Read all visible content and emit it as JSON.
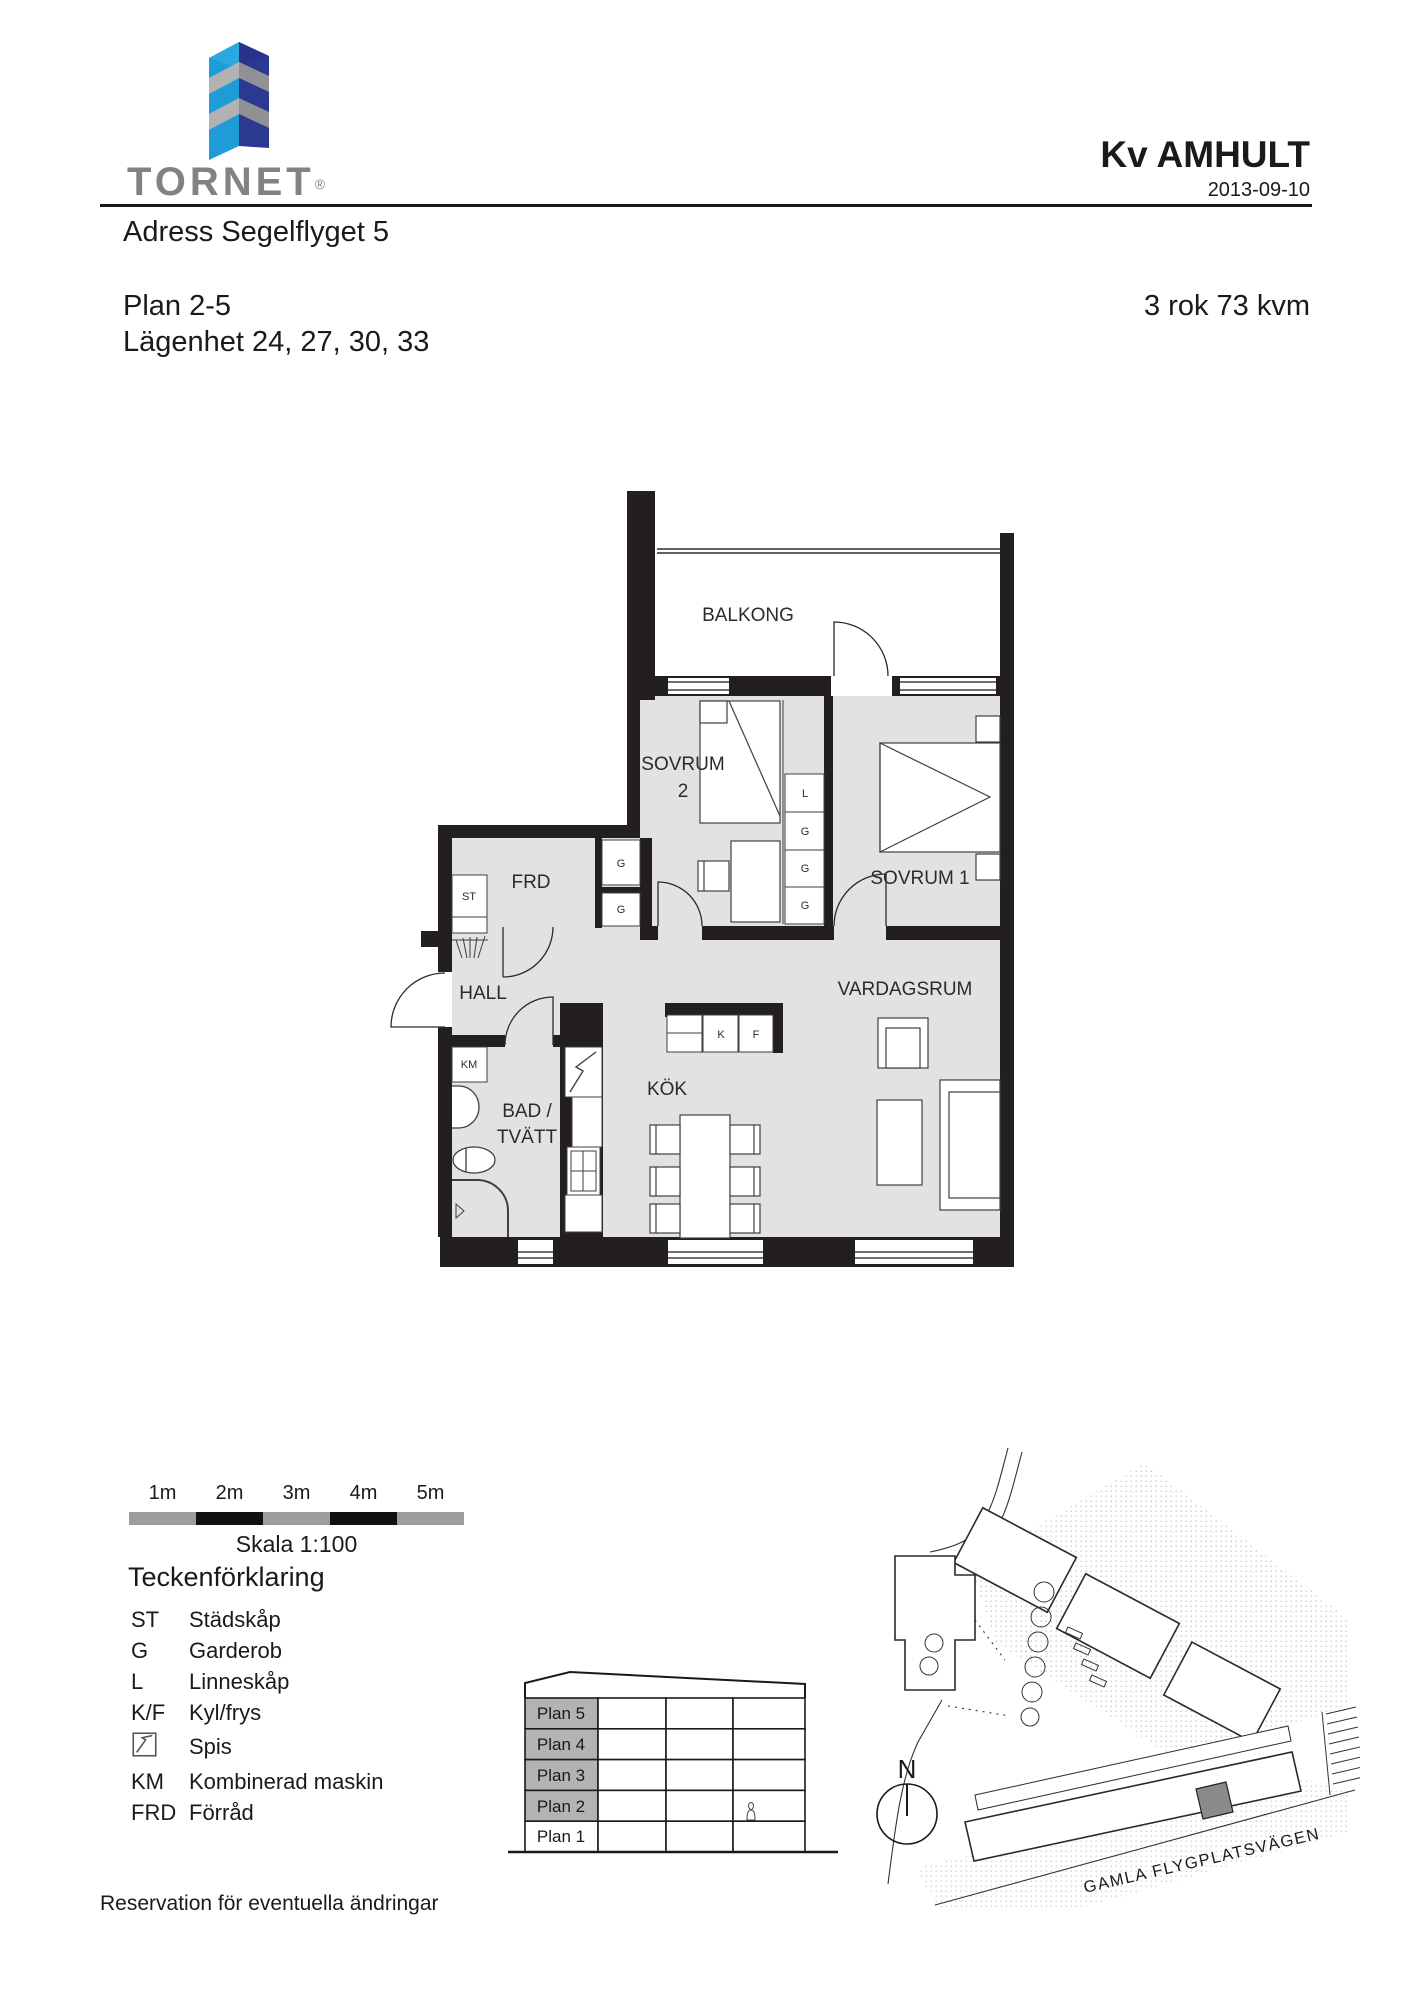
{
  "header": {
    "brand": "TORNET",
    "registered": "®",
    "project": "Kv AMHULT",
    "date": "2013-09-10",
    "address": "Adress Segelflyget 5",
    "plan": "Plan 2-5",
    "apartments": "Lägenhet 24, 27, 30, 33",
    "size": "3 rok 73 kvm"
  },
  "floor_plan": {
    "rooms": {
      "balcony": "BALKONG",
      "bedroom2_line1": "SOVRUM",
      "bedroom2_line2": "2",
      "bedroom1": "SOVRUM 1",
      "living": "VARDAGSRUM",
      "storage": "FRD",
      "hall": "HALL",
      "bath_line1": "BAD /",
      "bath_line2": "TVÄTT",
      "kitchen": "KÖK"
    },
    "markers": {
      "st": "ST",
      "km": "KM",
      "k": "K",
      "f": "F",
      "l": "L",
      "g1": "G",
      "g2": "G",
      "g3": "G",
      "g4": "G",
      "g5": "G",
      "g6": "G"
    }
  },
  "scale_bar": {
    "labels": [
      "1m",
      "2m",
      "3m",
      "4m",
      "5m"
    ],
    "caption": "Skala 1:100"
  },
  "legend": {
    "title": "Teckenförklaring",
    "items": [
      {
        "abbr": "ST",
        "label": "Städskåp"
      },
      {
        "abbr": "G",
        "label": "Garderob"
      },
      {
        "abbr": "L",
        "label": "Linneskåp"
      },
      {
        "abbr": "K/F",
        "label": "Kyl/frys"
      },
      {
        "abbr": "",
        "label": "Spis"
      },
      {
        "abbr": "KM",
        "label": "Kombinerad maskin"
      },
      {
        "abbr": "FRD",
        "label": "Förråd"
      }
    ]
  },
  "section": {
    "floors": [
      "Plan 5",
      "Plan 4",
      "Plan 3",
      "Plan 2",
      "Plan 1"
    ]
  },
  "site_plan": {
    "north": "N",
    "street": "GAMLA FLYGPLATSVÄGEN"
  },
  "footer": {
    "disclaimer": "Reservation för eventuella ändringar"
  },
  "colors": {
    "wall": "#231f20",
    "floor": "#e2e2e4",
    "logo_blue": "#1e9cd7",
    "logo_navy": "#2b3990",
    "logo_grey": "#b0b2b4",
    "brand_grey": "#808285",
    "section_highlight": "#b3b3b3"
  }
}
